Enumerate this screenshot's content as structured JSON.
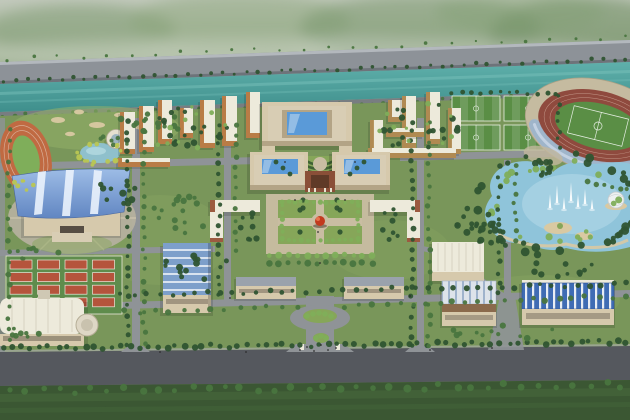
{
  "meta": {
    "width": 630,
    "height": 420,
    "scene": "university-campus-aerial-masterplan-rendering"
  },
  "colors": {
    "highway": "#8d9298",
    "highway_edge": "#b3b8bd",
    "river": "#4aa09d",
    "river_light": "#7cc4bd",
    "bank_road": "#787d81",
    "campus_green": "#79965a",
    "campus_light": "#94b168",
    "campus_dark": "#5a7942",
    "lawn_dark": "#3b5733",
    "lawn_streak": "#47683c",
    "road": "#8f9397",
    "road_dark": "#55585e",
    "track_orange": "#c06a42",
    "infield_green": "#7fae5a",
    "court_green": "#5f8c4c",
    "court_red": "#b5543c",
    "field_green": "#5a8e45",
    "stadium_track": "#8f4a3e",
    "stadium_stand": "#9db4cc",
    "stadium_base": "#c5bba0",
    "lake": "#8fc4da",
    "lake_light": "#b9dcea",
    "sand": "#d9c9a2",
    "fountain": "#ffffff",
    "roof_white": "#edeadb",
    "roof_grey": "#9aa2ac",
    "pave_light": "#d8cdb4",
    "wall_beige": "#d6c9ac",
    "wall_face": "#b3a486",
    "glass_blue": "#5a9ad8",
    "gym_roof_hi": "#9dbce6",
    "gym_roof_lo": "#6186c2",
    "ribbed_blue": "#7d9fca",
    "stripe_blue": "#3f6cb4",
    "louver_brown": "#8a6a4c",
    "gate_red": "#8a4f38",
    "accent_brick": "#9c5a40",
    "sculpture_red": "#c23a1e",
    "tree_dark": "#2f5431",
    "tree_mid": "#49753f",
    "tree_light": "#7fae5a",
    "tree_yellow": "#b9c653",
    "hedge_dark": "#3f6234",
    "garden_green": "#86a659",
    "plaza_pave": "#c9bda2",
    "plaza_grey": "#b5b09e",
    "pond": "#8fc0cc",
    "canteen_roof": "#e6e0d0",
    "window_band": "#6b6254",
    "people": "#2b2b2b"
  },
  "generated": {
    "mountain_blobs": [
      {
        "cx": 80,
        "cy": 30,
        "rx": 95,
        "ry": 26,
        "c": "#7e9a70",
        "o": 0.5
      },
      {
        "cx": 240,
        "cy": 22,
        "rx": 110,
        "ry": 30,
        "c": "#8aa47a",
        "o": 0.45
      },
      {
        "cx": 420,
        "cy": 28,
        "rx": 120,
        "ry": 34,
        "c": "#76946a",
        "o": 0.5
      },
      {
        "cx": 585,
        "cy": 38,
        "rx": 95,
        "ry": 42,
        "c": "#6d8c62",
        "o": 0.55
      },
      {
        "cx": 520,
        "cy": 12,
        "rx": 85,
        "ry": 22,
        "c": "#82a072",
        "o": 0.4
      },
      {
        "cx": 140,
        "cy": 58,
        "rx": 160,
        "ry": 18,
        "c": "#9db28e",
        "o": 0.35
      },
      {
        "cx": 480,
        "cy": 68,
        "rx": 160,
        "ry": 20,
        "c": "#8fa682",
        "o": 0.3
      },
      {
        "cx": 300,
        "cy": 54,
        "rx": 330,
        "ry": 16,
        "c": "#d3d9cf",
        "o": 0.45
      }
    ],
    "bunkers": [
      {
        "cx": 58,
        "cy": 120,
        "rx": 7,
        "ry": 3
      },
      {
        "cx": 79,
        "cy": 112,
        "rx": 5,
        "ry": 2.4
      },
      {
        "cx": 97,
        "cy": 125,
        "rx": 8,
        "ry": 3
      },
      {
        "cx": 119,
        "cy": 115,
        "rx": 5,
        "ry": 2.2
      },
      {
        "cx": 141,
        "cy": 127,
        "rx": 6,
        "ry": 2.6
      },
      {
        "cx": 70,
        "cy": 134,
        "rx": 5,
        "ry": 2.2
      }
    ],
    "fountain_jets": [
      [
        550,
        208,
        14
      ],
      [
        557,
        203,
        18
      ],
      [
        564,
        209,
        12
      ],
      [
        571,
        201,
        19
      ],
      [
        578,
        207,
        13
      ],
      [
        585,
        204,
        15
      ],
      [
        592,
        209,
        10
      ]
    ],
    "tennis": {
      "x": 6,
      "y": 256,
      "w": 116,
      "h": 58,
      "cols": 4,
      "rows": 4,
      "cw": 22,
      "ch": 9,
      "gx": 5.5,
      "gy": 3.6,
      "mx": 4,
      "my": 4
    },
    "soccer": {
      "x": 452,
      "y": 96,
      "cols": 2,
      "rows": 2,
      "fw": 48,
      "fh": 25,
      "gap": 4
    },
    "dorm_clusters": [
      {
        "into": "gDormsL",
        "roof": "roof_white",
        "face": "#b97c46",
        "items": [
          {
            "x": 120,
            "y": 112,
            "w": 15,
            "h": 42
          },
          {
            "x": 139,
            "y": 106,
            "w": 15,
            "h": 46
          },
          {
            "x": 158,
            "y": 100,
            "w": 14,
            "h": 44
          },
          {
            "x": 180,
            "y": 108,
            "w": 13,
            "h": 30
          },
          {
            "x": 200,
            "y": 100,
            "w": 15,
            "h": 48
          },
          {
            "x": 222,
            "y": 96,
            "w": 15,
            "h": 50
          },
          {
            "x": 246,
            "y": 92,
            "w": 14,
            "h": 46
          },
          {
            "x": 118,
            "y": 158,
            "w": 52,
            "h": 9
          }
        ]
      },
      {
        "into": "gDormsR",
        "roof": "roof_white",
        "face": "#b08a52",
        "items": [
          {
            "x": 370,
            "y": 120,
            "w": 13,
            "h": 40
          },
          {
            "x": 388,
            "y": 100,
            "w": 14,
            "h": 22
          },
          {
            "x": 402,
            "y": 96,
            "w": 14,
            "h": 52
          },
          {
            "x": 426,
            "y": 92,
            "w": 14,
            "h": 52
          },
          {
            "x": 448,
            "y": 108,
            "w": 13,
            "h": 46
          },
          {
            "x": 368,
            "y": 148,
            "w": 88,
            "h": 10
          },
          {
            "x": 386,
            "y": 128,
            "w": 38,
            "h": 9
          }
        ]
      }
    ],
    "scatter": [
      {
        "mode": "row",
        "into": "gHwTrees",
        "x1": 8,
        "y1": 59,
        "x2": 624,
        "y2": 37,
        "n": 26,
        "r": 1.5,
        "j": 2,
        "c": "tree_mid",
        "name": "highway-tree"
      },
      {
        "mode": "row",
        "into": "gHwTrees",
        "x1": 4,
        "y1": 81,
        "x2": 626,
        "y2": 59,
        "n": 55,
        "r": 1.8,
        "j": 1.5,
        "c": "tree_dark",
        "name": "highway-tree"
      },
      {
        "mode": "row",
        "into": "gBankTrees",
        "x1": 3,
        "y1": 116,
        "x2": 627,
        "y2": 94,
        "n": 55,
        "r": 2.2,
        "j": 2,
        "c": "tree_mid",
        "name": "riverbank-tree"
      },
      {
        "mode": "row",
        "into": "gBankTrees",
        "x1": 2,
        "y1": 122,
        "x2": 628,
        "y2": 100,
        "n": 36,
        "r": 2.4,
        "j": 2.5,
        "c": "tree_dark",
        "name": "riverbank-tree"
      },
      {
        "mode": "row",
        "x1": 4,
        "y1": 348,
        "x2": 626,
        "y2": 342,
        "n": 70,
        "r": 2.8,
        "j": 2,
        "c": "tree_dark",
        "name": "avenue-tree"
      },
      {
        "mode": "row",
        "x1": 10,
        "y1": 391,
        "x2": 622,
        "y2": 385,
        "n": 38,
        "r": 3.2,
        "j": 3,
        "c": "tree_mid",
        "name": "avenue-tree"
      },
      {
        "mode": "row",
        "x1": 128,
        "y1": 122,
        "x2": 128,
        "y2": 344,
        "n": 24,
        "r": 2.4,
        "j": 1.5,
        "c": "tree_dark",
        "name": "street-tree"
      },
      {
        "mode": "row",
        "x1": 144,
        "y1": 122,
        "x2": 144,
        "y2": 344,
        "n": 22,
        "r": 2.3,
        "j": 1.5,
        "c": "tree_mid",
        "name": "street-tree"
      },
      {
        "mode": "row",
        "x1": 219,
        "y1": 124,
        "x2": 219,
        "y2": 296,
        "n": 18,
        "r": 2.4,
        "j": 1.5,
        "c": "tree_dark",
        "name": "street-tree"
      },
      {
        "mode": "row",
        "x1": 236,
        "y1": 124,
        "x2": 236,
        "y2": 252,
        "n": 13,
        "r": 2.2,
        "j": 1.5,
        "c": "tree_mid",
        "name": "street-tree"
      },
      {
        "mode": "row",
        "x1": 412,
        "y1": 122,
        "x2": 412,
        "y2": 346,
        "n": 24,
        "r": 2.4,
        "j": 1.5,
        "c": "tree_dark",
        "name": "street-tree"
      },
      {
        "mode": "row",
        "x1": 429,
        "y1": 122,
        "x2": 429,
        "y2": 346,
        "n": 22,
        "r": 2.3,
        "j": 1.5,
        "c": "tree_mid",
        "name": "street-tree"
      },
      {
        "mode": "row",
        "x1": 499,
        "y1": 166,
        "x2": 499,
        "y2": 294,
        "n": 13,
        "r": 2.3,
        "j": 1.5,
        "c": "tree_dark",
        "name": "street-tree"
      },
      {
        "mode": "row",
        "x1": 515,
        "y1": 166,
        "x2": 515,
        "y2": 240,
        "n": 9,
        "r": 2.2,
        "j": 1.5,
        "c": "tree_mid",
        "name": "street-tree"
      },
      {
        "mode": "row",
        "x1": 9,
        "y1": 130,
        "x2": 9,
        "y2": 340,
        "n": 20,
        "r": 2.4,
        "j": 1.5,
        "c": "tree_mid",
        "name": "street-tree"
      },
      {
        "mode": "row",
        "x1": 122,
        "y1": 295,
        "x2": 626,
        "y2": 284,
        "n": 42,
        "r": 2.5,
        "j": 2,
        "c": "tree_dark",
        "name": "street-tree"
      },
      {
        "mode": "row",
        "x1": 126,
        "y1": 312,
        "x2": 296,
        "y2": 306,
        "n": 13,
        "r": 2.6,
        "j": 2,
        "c": "tree_mid",
        "name": "street-tree"
      },
      {
        "mode": "row",
        "x1": 346,
        "y1": 306,
        "x2": 626,
        "y2": 296,
        "n": 22,
        "r": 2.6,
        "j": 2,
        "c": "tree_mid",
        "name": "street-tree"
      },
      {
        "mode": "row",
        "x1": 270,
        "y1": 255,
        "x2": 372,
        "y2": 255,
        "n": 12,
        "r": 2.8,
        "j": 1,
        "c": "tree_light",
        "name": "allee-tree"
      },
      {
        "mode": "row",
        "x1": 270,
        "y1": 263,
        "x2": 372,
        "y2": 263,
        "n": 12,
        "r": 2.8,
        "j": 1,
        "c": "tree_mid",
        "name": "allee-tree"
      },
      {
        "mode": "row",
        "x1": 452,
        "y1": 93,
        "x2": 556,
        "y2": 93,
        "n": 12,
        "r": 2,
        "j": 1.5,
        "c": "tree_dark",
        "name": "pitch-tree"
      },
      {
        "mode": "row",
        "x1": 559,
        "y1": 96,
        "x2": 559,
        "y2": 148,
        "n": 7,
        "r": 2,
        "j": 1.5,
        "c": "tree_dark",
        "name": "pitch-tree"
      },
      {
        "mode": "row",
        "x1": 588,
        "y1": 182,
        "x2": 628,
        "y2": 190,
        "n": 6,
        "r": 2.4,
        "j": 1.5,
        "c": "tree_mid",
        "name": "stadium-tree"
      },
      {
        "mode": "patch",
        "cx": 150,
        "cy": 122,
        "rx": 42,
        "ry": 13,
        "n": 12,
        "r": 2.6,
        "c": "tree_mid",
        "name": "golf-tree"
      },
      {
        "mode": "patch",
        "cx": 120,
        "cy": 140,
        "rx": 30,
        "ry": 8,
        "n": 6,
        "r": 2.2,
        "c": "tree_mid",
        "name": "golf-tree"
      },
      {
        "mode": "ring",
        "cx": 100,
        "cy": 153,
        "rx": 21,
        "ry": 11,
        "n": 15,
        "r": 2.4,
        "j": 2,
        "c": "tree_yellow",
        "name": "pond-tree"
      },
      {
        "mode": "patch",
        "cx": 30,
        "cy": 185,
        "rx": 18,
        "ry": 8,
        "n": 6,
        "r": 2.2,
        "c": "tree_yellow",
        "name": "pond-tree"
      },
      {
        "mode": "patch",
        "cx": 118,
        "cy": 192,
        "rx": 26,
        "ry": 14,
        "n": 10,
        "r": 2.8,
        "c": "tree_dark",
        "name": "garden-tree"
      },
      {
        "mode": "patch",
        "cx": 40,
        "cy": 255,
        "rx": 28,
        "ry": 9,
        "n": 8,
        "r": 2.6,
        "c": "tree_mid",
        "name": "garden-tree"
      },
      {
        "mode": "patch",
        "cx": 182,
        "cy": 215,
        "rx": 30,
        "ry": 22,
        "n": 16,
        "r": 2.8,
        "c": "tree_mid",
        "name": "garden-tree"
      },
      {
        "mode": "patch",
        "cx": 196,
        "cy": 268,
        "rx": 38,
        "ry": 14,
        "n": 12,
        "r": 2.8,
        "c": "tree_dark",
        "name": "garden-tree"
      },
      {
        "mode": "patch",
        "cx": 250,
        "cy": 226,
        "rx": 10,
        "ry": 18,
        "n": 8,
        "r": 2.4,
        "c": "tree_dark",
        "name": "garden-tree"
      },
      {
        "mode": "patch",
        "cx": 390,
        "cy": 226,
        "rx": 10,
        "ry": 18,
        "n": 8,
        "r": 2.4,
        "c": "tree_dark",
        "name": "garden-tree"
      },
      {
        "mode": "patch",
        "cx": 188,
        "cy": 130,
        "rx": 40,
        "ry": 24,
        "n": 18,
        "r": 2.6,
        "c": "tree_dark",
        "name": "dorm-tree"
      },
      {
        "mode": "patch",
        "cx": 188,
        "cy": 130,
        "rx": 40,
        "ry": 24,
        "n": 10,
        "r": 2.2,
        "c": "tree_light",
        "name": "dorm-tree"
      },
      {
        "mode": "patch",
        "cx": 420,
        "cy": 128,
        "rx": 42,
        "ry": 26,
        "n": 18,
        "r": 2.6,
        "c": "tree_dark",
        "name": "dorm-tree"
      },
      {
        "mode": "patch",
        "cx": 420,
        "cy": 128,
        "rx": 42,
        "ry": 26,
        "n": 10,
        "r": 2.2,
        "c": "tree_light",
        "name": "dorm-tree"
      },
      {
        "mode": "ring",
        "into": "gLakeTrees",
        "cx": 558,
        "cy": 204,
        "rx": 80,
        "ry": 48,
        "n": 40,
        "r": 3.4,
        "j": 6,
        "c": "tree_dark",
        "name": "lake-tree"
      },
      {
        "mode": "ring",
        "into": "gLakeTrees",
        "cx": 556,
        "cy": 202,
        "rx": 62,
        "ry": 38,
        "n": 22,
        "r": 2.8,
        "j": 5,
        "c": "tree_light",
        "name": "lake-tree"
      },
      {
        "mode": "patch",
        "into": "gLakeTrees",
        "cx": 478,
        "cy": 228,
        "rx": 26,
        "ry": 22,
        "n": 20,
        "r": 3,
        "c": "tree_dark",
        "name": "lake-wood-tree"
      },
      {
        "mode": "patch",
        "into": "gLakeTrees",
        "cx": 542,
        "cy": 168,
        "rx": 10,
        "ry": 16,
        "n": 8,
        "r": 2.6,
        "c": "tree_dark",
        "name": "lake-wood-tree"
      },
      {
        "mode": "patch",
        "cx": 505,
        "cy": 332,
        "rx": 55,
        "ry": 8,
        "n": 12,
        "r": 2.6,
        "c": "tree_mid",
        "name": "garden-tree"
      },
      {
        "mode": "patch",
        "cx": 565,
        "cy": 268,
        "rx": 35,
        "ry": 9,
        "n": 10,
        "r": 2.6,
        "c": "tree_dark",
        "name": "garden-tree"
      },
      {
        "mode": "patch",
        "cx": 32,
        "cy": 332,
        "rx": 24,
        "ry": 7,
        "n": 7,
        "r": 2.6,
        "c": "tree_mid",
        "name": "garden-tree"
      },
      {
        "mode": "points",
        "pts": [
          [
            283,
            168
          ],
          [
            290,
            174
          ],
          [
            350,
            174
          ],
          [
            357,
            168
          ],
          [
            276,
            162
          ],
          [
            364,
            162
          ]
        ],
        "r": 2.4,
        "c": "tree_dark",
        "name": "hedge-tree"
      },
      {
        "mode": "points",
        "pts": [
          [
            303,
            200
          ],
          [
            337,
            200
          ],
          [
            303,
            208
          ],
          [
            337,
            208
          ]
        ],
        "r": 2.6,
        "c": "tree_dark",
        "name": "gate-tree"
      },
      {
        "mode": "row",
        "x1": 282,
        "y1": 202,
        "x2": 358,
        "y2": 202,
        "n": 13,
        "r": 2.2,
        "j": 0.8,
        "c": "tree_light",
        "name": "plaza-tree"
      },
      {
        "mode": "row",
        "x1": 282,
        "y1": 240,
        "x2": 358,
        "y2": 240,
        "n": 13,
        "r": 2.2,
        "j": 0.8,
        "c": "tree_light",
        "name": "plaza-tree"
      },
      {
        "mode": "row",
        "x1": 282,
        "y1": 206,
        "x2": 282,
        "y2": 238,
        "n": 6,
        "r": 2.2,
        "j": 0.8,
        "c": "tree_light",
        "name": "plaza-tree"
      },
      {
        "mode": "row",
        "x1": 358,
        "y1": 206,
        "x2": 358,
        "y2": 238,
        "n": 6,
        "r": 2.2,
        "j": 0.8,
        "c": "tree_light",
        "name": "plaza-tree"
      },
      {
        "mode": "points",
        "pts": [
          [
            300,
            210
          ],
          [
            340,
            210
          ],
          [
            300,
            232
          ],
          [
            340,
            232
          ]
        ],
        "r": 2.6,
        "c": "tree_dark",
        "name": "plaza-tree"
      },
      {
        "mode": "points",
        "into": "gRbTrees",
        "pts": [
          [
            307,
            316
          ],
          [
            313,
            314
          ],
          [
            319,
            313
          ],
          [
            325,
            314
          ],
          [
            331,
            316
          ],
          [
            316,
            338
          ],
          [
            321,
            336
          ],
          [
            326,
            338
          ]
        ],
        "r": 2.8,
        "c": "tree_light",
        "name": "roundabout-tree"
      },
      {
        "mode": "points",
        "into": "gPeople",
        "pts": [
          [
            300,
            350
          ],
          [
            307,
            347
          ],
          [
            314,
            351
          ],
          [
            321,
            345
          ],
          [
            328,
            350
          ],
          [
            336,
            348
          ],
          [
            246,
            352
          ],
          [
            430,
            350
          ],
          [
            492,
            348
          ],
          [
            160,
            352
          ],
          [
            320,
            263
          ],
          [
            318,
            232
          ],
          [
            345,
            200
          ],
          [
            295,
            200
          ],
          [
            230,
            298
          ],
          [
            410,
            296
          ],
          [
            355,
            162
          ],
          [
            285,
            162
          ]
        ],
        "r": 0.9,
        "c": "people",
        "name": "pedestrian"
      }
    ]
  }
}
